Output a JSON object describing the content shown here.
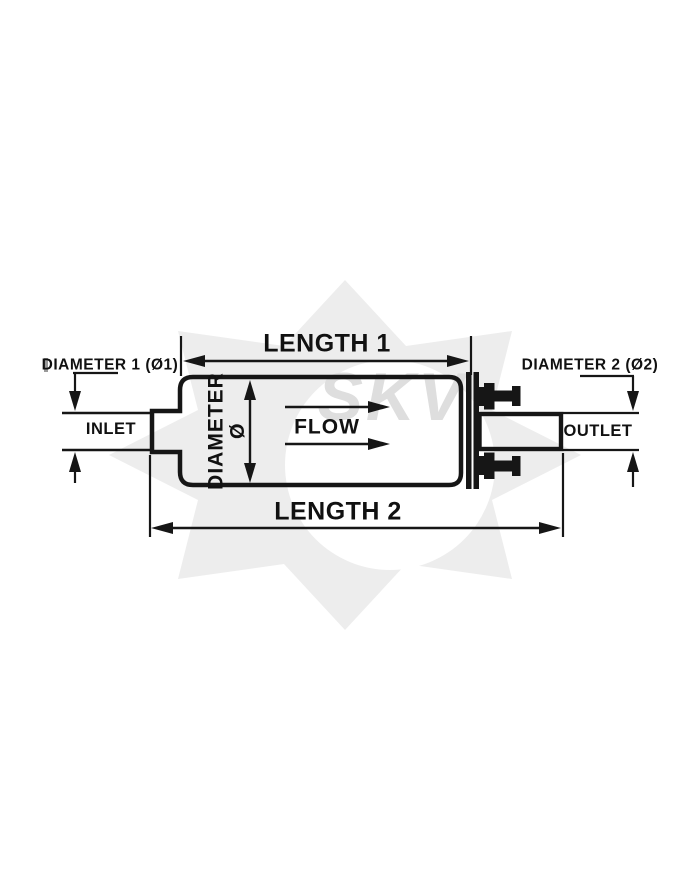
{
  "colors": {
    "background": "#ffffff",
    "line": "#161616",
    "watermark_shape": "#ededed",
    "watermark_text": "#dedede",
    "cropped_mark": "#9a9a9a"
  },
  "labels": {
    "length1": "LENGTH 1",
    "length2": "LENGTH 2",
    "diameter1": "DIAMETER 1 (Ø1)",
    "diameter2": "DIAMETER 2 (Ø2)",
    "inlet": "INLET",
    "outlet": "OUTLET",
    "flow": "FLOW",
    "body_diameter": "DIAMETER",
    "diameter_symbol": "Ø"
  },
  "watermark": {
    "text": "SKV"
  }
}
